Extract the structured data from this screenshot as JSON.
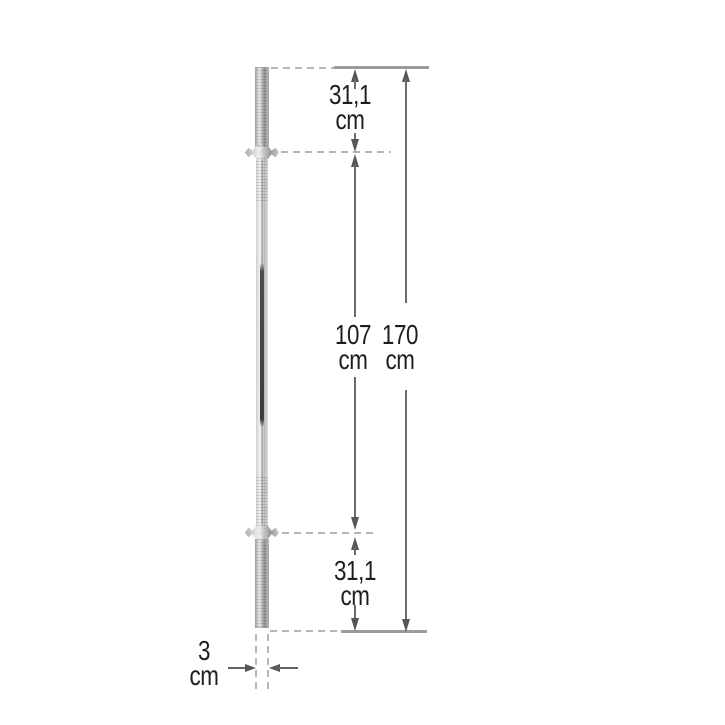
{
  "dimensions": {
    "top_sleeve": {
      "value": "31,1",
      "unit": "cm"
    },
    "shaft": {
      "value": "107",
      "unit": "cm"
    },
    "total": {
      "value": "170",
      "unit": "cm"
    },
    "bottom_sleeve": {
      "value": "31,1",
      "unit": "cm"
    },
    "diameter": {
      "value": "3",
      "unit": "cm"
    }
  },
  "colors": {
    "background": "#ffffff",
    "text": "#1d1d1d",
    "dimension_line": "#6b6b6b",
    "arrowhead": "#565656",
    "dashed_reference_line": "#b6b6b6",
    "solid_reference_line": "#9b9b9b",
    "bar_chrome_light": "#f7f7f7",
    "bar_chrome_dark": "#9e9e9e",
    "knurl_stripe": "#3c3c3c"
  }
}
